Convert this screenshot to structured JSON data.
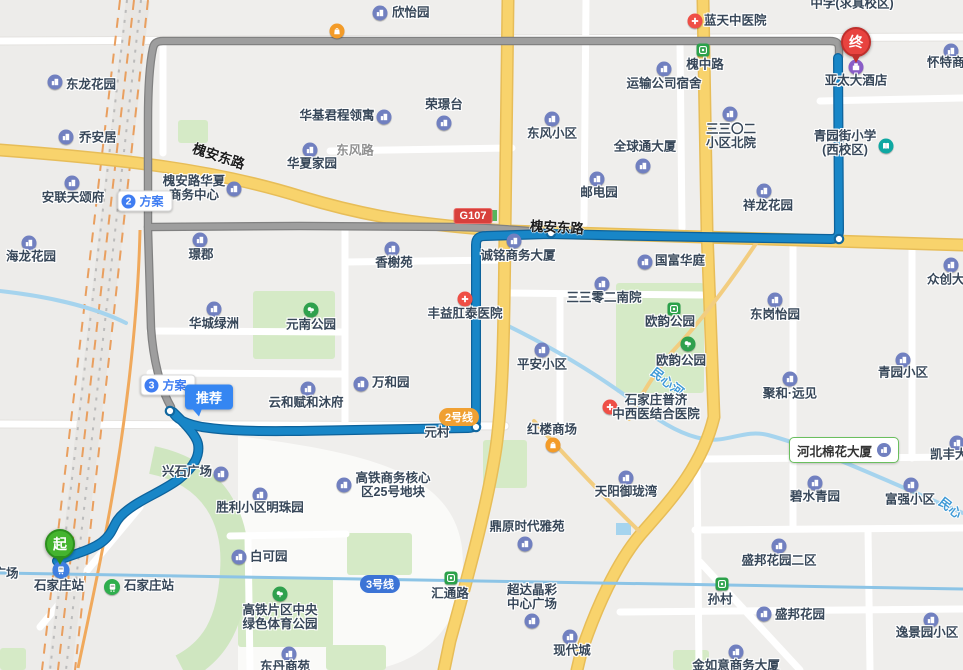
{
  "app": {
    "view": "route-map"
  },
  "colors": {
    "route_selected": "#1886c7",
    "route_alternative": "#9e9e9e",
    "road_arterial": "#f8d36c",
    "river": "#a6d4ee",
    "start_marker": "#44b42e",
    "end_marker": "#e8433f",
    "line2_badge": "#f0a032",
    "line3_badge": "#3c74d6",
    "g107_badge": "#d8403c",
    "highlight_border": "#6abf5e"
  },
  "markers": {
    "start": {
      "text": "起"
    },
    "end": {
      "text": "终"
    }
  },
  "plan_badges": [
    {
      "number": "2",
      "label": "方案"
    },
    {
      "number": "3",
      "label": "方案"
    }
  ],
  "tooltip": {
    "text": "推荐"
  },
  "road_badge": {
    "text": "G107"
  },
  "line_badges": [
    {
      "text": "2号线"
    },
    {
      "text": "3号线"
    }
  ],
  "highlight": {
    "text": "河北棉花大厦"
  },
  "road_labels": [
    {
      "t": "槐安东路",
      "x": 219,
      "y": 155,
      "rot": 18,
      "cls": "onroad"
    },
    {
      "t": "槐安东路",
      "x": 557,
      "y": 226,
      "rot": 3,
      "cls": "onroad"
    },
    {
      "t": "东风路",
      "x": 355,
      "y": 149,
      "rot": 0,
      "cls": "street"
    },
    {
      "t": "民心河",
      "x": 668,
      "y": 381,
      "rot": 38,
      "cls": "river"
    },
    {
      "t": "民心",
      "x": 951,
      "y": 507,
      "rot": 38,
      "cls": "river"
    }
  ],
  "pois": [
    {
      "t": "欣怡园",
      "icon": "building",
      "ix": 380,
      "iy": 13,
      "lx": 392,
      "ly": 13,
      "side": true
    },
    {
      "icon": "shopping",
      "ix": 337,
      "iy": 31
    },
    {
      "t": "蓝天中医院",
      "icon": "hospital",
      "ix": 695,
      "iy": 21,
      "lx": 704,
      "ly": 21,
      "side": true
    },
    {
      "t": "中学(求真校区)",
      "lx": 852,
      "ly": 4
    },
    {
      "t": "怀特商",
      "icon": "building",
      "ix": 951,
      "iy": 51,
      "lx": 927,
      "ly": 63,
      "side": true
    },
    {
      "t": "槐中路",
      "icon": "metro",
      "ix": 703,
      "iy": 50,
      "lx": 705,
      "ly": 65
    },
    {
      "t": "运输公司宿舍",
      "icon": "building",
      "ix": 664,
      "iy": 69,
      "lx": 664,
      "ly": 84
    },
    {
      "lines": [
        "三三〇二",
        "小区北院"
      ],
      "icon": "building",
      "ix": 730,
      "iy": 114,
      "lx": 731,
      "ly": 130
    },
    {
      "t": "东风小区",
      "icon": "building",
      "ix": 552,
      "iy": 119,
      "lx": 552,
      "ly": 134
    },
    {
      "t": "全球通大厦",
      "icon": "building",
      "ix": 643,
      "iy": 166,
      "lx": 645,
      "ly": 147
    },
    {
      "t": "荣璟台",
      "icon": "building",
      "ix": 444,
      "iy": 123,
      "lx": 444,
      "ly": 105
    },
    {
      "t": "华基君程领寓",
      "icon": "building",
      "ix": 384,
      "iy": 117,
      "lx": 337,
      "ly": 116
    },
    {
      "t": "华夏家园",
      "icon": "building",
      "ix": 310,
      "iy": 150,
      "lx": 312,
      "ly": 164
    },
    {
      "t": "邮电园",
      "icon": "building",
      "ix": 597,
      "iy": 179,
      "lx": 599,
      "ly": 193
    },
    {
      "lines": [
        "青园街小学",
        "(西校区)"
      ],
      "icon": "school",
      "ix": 886,
      "iy": 146,
      "lx": 845,
      "ly": 137
    },
    {
      "t": "亚太大酒店",
      "icon": "hotel",
      "ix": 856,
      "iy": 67,
      "lx": 856,
      "ly": 81
    },
    {
      "t": "祥龙花园",
      "icon": "building",
      "ix": 764,
      "iy": 191,
      "lx": 768,
      "ly": 206
    },
    {
      "t": "乔安居",
      "icon": "building",
      "ix": 66,
      "iy": 137,
      "lx": 79,
      "ly": 138,
      "side": true
    },
    {
      "t": "东龙花园",
      "icon": "building",
      "ix": 55,
      "iy": 82,
      "lx": 66,
      "ly": 85,
      "side": true
    },
    {
      "t": "安联天颂府",
      "icon": "building",
      "ix": 72,
      "iy": 183,
      "lx": 73,
      "ly": 198
    },
    {
      "lines": [
        "槐安路华夏",
        "商务中心"
      ],
      "icon": "building",
      "ix": 234,
      "iy": 189,
      "lx": 194,
      "ly": 182
    },
    {
      "t": "海龙花园",
      "icon": "building",
      "ix": 29,
      "iy": 243,
      "lx": 31,
      "ly": 257
    },
    {
      "t": "璟郡",
      "icon": "building",
      "ix": 200,
      "iy": 240,
      "lx": 201,
      "ly": 255
    },
    {
      "t": "香榭苑",
      "icon": "building",
      "ix": 392,
      "iy": 249,
      "lx": 394,
      "ly": 263
    },
    {
      "t": "诚铭商务大厦",
      "icon": "building",
      "ix": 514,
      "iy": 241,
      "lx": 518,
      "ly": 256
    },
    {
      "t": "丰益肛泰医院",
      "icon": "hospital",
      "ix": 465,
      "iy": 299,
      "lx": 465,
      "ly": 314
    },
    {
      "t": "三三零二南院",
      "icon": "building",
      "ix": 602,
      "iy": 284,
      "lx": 604,
      "ly": 298
    },
    {
      "t": "国富华庭",
      "icon": "building",
      "ix": 645,
      "iy": 262,
      "lx": 655,
      "ly": 261,
      "side": true
    },
    {
      "t": "东岗怡园",
      "icon": "building",
      "ix": 775,
      "iy": 300,
      "lx": 775,
      "ly": 315
    },
    {
      "t": "欧韵公园",
      "icon": "metro",
      "ix": 674,
      "iy": 309,
      "lx": 670,
      "ly": 322
    },
    {
      "t": "欧韵公园",
      "icon": "park",
      "ix": 688,
      "iy": 344,
      "lx": 681,
      "ly": 361
    },
    {
      "t": "聚和·远见",
      "icon": "building",
      "ix": 790,
      "iy": 379,
      "lx": 790,
      "ly": 394
    },
    {
      "t": "青园小区",
      "icon": "building",
      "ix": 903,
      "iy": 360,
      "lx": 903,
      "ly": 373
    },
    {
      "t": "众创大",
      "icon": "building",
      "ix": 951,
      "iy": 265,
      "lx": 927,
      "ly": 280,
      "side": true
    },
    {
      "t": "凯丰大",
      "icon": "building",
      "ix": 957,
      "iy": 443,
      "lx": 930,
      "ly": 455,
      "side": true
    },
    {
      "t": "平安小区",
      "icon": "building",
      "ix": 542,
      "iy": 350,
      "lx": 542,
      "ly": 365
    },
    {
      "t": "万和园",
      "icon": "building",
      "ix": 361,
      "iy": 384,
      "lx": 372,
      "ly": 383,
      "side": true
    },
    {
      "t": "云和赋和沐府",
      "icon": "building",
      "ix": 308,
      "iy": 389,
      "lx": 306,
      "ly": 403
    },
    {
      "t": "华城绿洲",
      "icon": "building",
      "ix": 214,
      "iy": 309,
      "lx": 214,
      "ly": 324
    },
    {
      "t": "元南公园",
      "icon": "park",
      "ix": 311,
      "iy": 310,
      "lx": 311,
      "ly": 325
    },
    {
      "lines": [
        "石家庄普济",
        "中西医结合医院"
      ],
      "icon": "hospital",
      "ix": 610,
      "iy": 407,
      "lx": 656,
      "ly": 401
    },
    {
      "t": "红楼商场",
      "icon": "shopping",
      "ix": 553,
      "iy": 445,
      "lx": 552,
      "ly": 430
    },
    {
      "t": "天阳御珑湾",
      "icon": "building",
      "ix": 626,
      "iy": 478,
      "lx": 626,
      "ly": 492
    },
    {
      "t": "鼎原时代雅苑",
      "icon": "building",
      "ix": 525,
      "iy": 544,
      "lx": 527,
      "ly": 527
    },
    {
      "t": "碧水青园",
      "icon": "building",
      "ix": 815,
      "iy": 483,
      "lx": 815,
      "ly": 497
    },
    {
      "t": "富强小区",
      "icon": "building",
      "ix": 911,
      "iy": 485,
      "lx": 910,
      "ly": 500
    },
    {
      "t": "盛邦花园二区",
      "icon": "building",
      "ix": 779,
      "iy": 546,
      "lx": 779,
      "ly": 561
    },
    {
      "t": "孙村",
      "icon": "metro",
      "ix": 722,
      "iy": 584,
      "lx": 720,
      "ly": 600
    },
    {
      "t": "盛邦花园",
      "icon": "building",
      "ix": 764,
      "iy": 614,
      "lx": 775,
      "ly": 615,
      "side": true
    },
    {
      "t": "逸景园小区",
      "icon": "building",
      "ix": 931,
      "iy": 620,
      "lx": 927,
      "ly": 633
    },
    {
      "t": "金如意商务大厦",
      "icon": "building",
      "ix": 736,
      "iy": 652,
      "lx": 736,
      "ly": 666
    },
    {
      "t": "现代城",
      "icon": "building",
      "ix": 570,
      "iy": 637,
      "lx": 572,
      "ly": 651
    },
    {
      "lines": [
        "超达晶彩",
        "中心广场"
      ],
      "icon": "building",
      "ix": 532,
      "iy": 621,
      "lx": 532,
      "ly": 591
    },
    {
      "t": "汇通路",
      "icon": "metro",
      "ix": 451,
      "iy": 578,
      "lx": 450,
      "ly": 594
    },
    {
      "lines": [
        "高铁商务核心",
        "区25号地块"
      ],
      "icon": "building",
      "ix": 344,
      "iy": 485,
      "lx": 393,
      "ly": 479
    },
    {
      "t": "兴石广场",
      "icon": "building",
      "ix": 221,
      "iy": 474,
      "lx": 187,
      "ly": 472
    },
    {
      "t": "胜利小区明珠园",
      "icon": "building",
      "ix": 260,
      "iy": 495,
      "lx": 260,
      "ly": 508
    },
    {
      "t": "白可园",
      "icon": "building",
      "ix": 239,
      "iy": 557,
      "lx": 250,
      "ly": 557,
      "side": true
    },
    {
      "lines": [
        "高铁片区中央",
        "绿色体育公园"
      ],
      "icon": "park",
      "ix": 280,
      "iy": 594,
      "lx": 280,
      "ly": 611
    },
    {
      "t": "石家庄站",
      "icon": "train-blue",
      "ix": 61,
      "iy": 570,
      "lx": 59,
      "ly": 586
    },
    {
      "t": "石家庄站",
      "icon": "train-green",
      "ix": 112,
      "iy": 587,
      "lx": 124,
      "ly": 586,
      "side": true
    },
    {
      "t": "广场",
      "lx": 6,
      "ly": 574
    },
    {
      "t": "东丹商苑",
      "icon": "building",
      "ix": 289,
      "iy": 654,
      "lx": 285,
      "ly": 667
    },
    {
      "t": "元村",
      "lx": 437,
      "ly": 433
    }
  ]
}
